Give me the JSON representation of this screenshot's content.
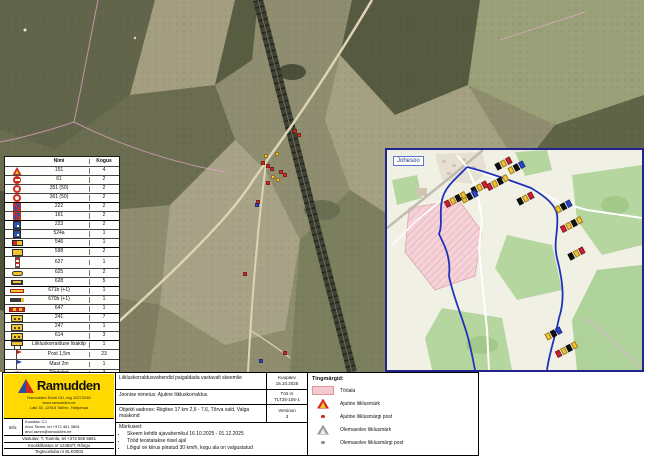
{
  "colors": {
    "brand_yellow": "#ffd900",
    "accent_red": "#cf2a1f",
    "accent_blue": "#2a52b0",
    "work_area_pink": "#f4c9cf",
    "inset_border": "#23238e",
    "route_blue": "#2233bb"
  },
  "sign_table": {
    "col_name": "Nimi",
    "col_qty": "Kogus",
    "rows": [
      {
        "icon": "tri-red",
        "name": "151",
        "qty": "4"
      },
      {
        "icon": "circ-noentry",
        "name": "61",
        "qty": "2"
      },
      {
        "icon": "circ-ring",
        "name": "351 (50)",
        "qty": "2"
      },
      {
        "icon": "circ-ring",
        "name": "361 (50)",
        "qty": "2"
      },
      {
        "icon": "sq-bluered",
        "name": "222",
        "qty": "2"
      },
      {
        "icon": "sq-bluered",
        "name": "161",
        "qty": "2"
      },
      {
        "icon": "sq-blue",
        "name": "223",
        "qty": "2"
      },
      {
        "icon": "sq-blue",
        "name": "524a",
        "qty": "1"
      },
      {
        "icon": "bar-yr",
        "name": "546",
        "qty": "1"
      },
      {
        "icon": "rect-y",
        "name": "598",
        "qty": "2"
      },
      {
        "icon": "pole",
        "name": "627",
        "qty": "1"
      },
      {
        "icon": "oval-y",
        "name": "625",
        "qty": "2"
      },
      {
        "icon": "rect-dk",
        "name": "628",
        "qty": "5"
      },
      {
        "icon": "bar-ylong",
        "name": "671b (+1)",
        "qty": "1"
      },
      {
        "icon": "bar-dark",
        "name": "670b (+1)",
        "qty": "1"
      },
      {
        "icon": "bar-striped",
        "name": "647",
        "qty": "1"
      },
      {
        "icon": "rect-ydots",
        "name": "241",
        "qty": "7"
      },
      {
        "icon": "rect-ydots",
        "name": "247",
        "qty": "1"
      },
      {
        "icon": "rect-ydots",
        "name": "614",
        "qty": "3"
      },
      {
        "icon": "board",
        "name": "Liikluskorralduse lisakilp",
        "qty": "1"
      },
      {
        "icon": "flag-red",
        "name": "Post 1,5m",
        "qty": "23"
      },
      {
        "icon": "flag-blue",
        "name": "Mast 2m",
        "qty": "1"
      },
      {
        "icon": "zigzag",
        "name": "Piirdelint",
        "qty": "3"
      }
    ],
    "group_breaks": [
      4,
      6,
      9,
      13,
      16,
      19
    ]
  },
  "map": {
    "markers": [
      {
        "x": 293,
        "y": 129,
        "c": "red"
      },
      {
        "x": 297,
        "y": 133,
        "c": "red"
      },
      {
        "x": 275,
        "y": 152,
        "c": "yellow"
      },
      {
        "x": 264,
        "y": 154,
        "c": "yellow"
      },
      {
        "x": 261,
        "y": 161,
        "c": "red"
      },
      {
        "x": 266,
        "y": 164,
        "c": "red"
      },
      {
        "x": 270,
        "y": 167,
        "c": "red"
      },
      {
        "x": 279,
        "y": 170,
        "c": "red"
      },
      {
        "x": 283,
        "y": 173,
        "c": "red"
      },
      {
        "x": 271,
        "y": 175,
        "c": "yellow"
      },
      {
        "x": 276,
        "y": 178,
        "c": "yellow"
      },
      {
        "x": 266,
        "y": 181,
        "c": "red"
      },
      {
        "x": 256,
        "y": 200,
        "c": "red"
      },
      {
        "x": 255,
        "y": 203,
        "c": "blue"
      },
      {
        "x": 243,
        "y": 272,
        "c": "red"
      },
      {
        "x": 283,
        "y": 351,
        "c": "red"
      },
      {
        "x": 259,
        "y": 359,
        "c": "blue"
      }
    ]
  },
  "inset": {
    "label": "Johesoo",
    "clusters": [
      {
        "x": 108,
        "y": 10
      },
      {
        "x": 121,
        "y": 14
      },
      {
        "x": 99,
        "y": 29
      },
      {
        "x": 84,
        "y": 34
      },
      {
        "x": 74,
        "y": 43
      },
      {
        "x": 57,
        "y": 46
      },
      {
        "x": 130,
        "y": 45
      },
      {
        "x": 168,
        "y": 53
      },
      {
        "x": 173,
        "y": 71
      },
      {
        "x": 181,
        "y": 100
      },
      {
        "x": 158,
        "y": 180
      },
      {
        "x": 168,
        "y": 196
      }
    ]
  },
  "legend": {
    "title": "Tingmärgid:",
    "items": [
      {
        "icon": "lg-pink",
        "label": "Tööala"
      },
      {
        "icon": "lg-tri-red",
        "label": "Ajutine liiklusmärk"
      },
      {
        "icon": "lg-dot-red",
        "label": "Ajutine liiklusmärgi post"
      },
      {
        "icon": "lg-tri-gray",
        "label": "Olemasolev liiklusmärk"
      },
      {
        "icon": "lg-dot-gray",
        "label": "Olemasolev liiklusmärgi post"
      }
    ]
  },
  "titleblock": {
    "row1": "Liikluskorraldusvahendid paigaldada vastavalt skeemile",
    "date_label": "Kuupäev",
    "date": "16.10.2025",
    "drawing_label": "Joonise nimetus:",
    "drawing": "Ajutine liikluskorraldus.",
    "job_label": "Töö nr",
    "job": "TLT25-105-1",
    "address_label": "Objekti aadress:",
    "address": "Riigitee 17 km 2,6 - 7,6, Tõrva vald, Valga maakond",
    "version_label": "Versioon",
    "version": "3",
    "notes_label": "Märkused:",
    "notes": [
      "Skeem kehtib ajavahemikul 16.10.2025 - 01.12.2025",
      "Tööd teostatakse öisel ajal",
      "Lõigul on kiirus piiratud 30 km/h, kogu ala on valgustatud"
    ]
  },
  "company": {
    "brand": "Ramudden",
    "addr1": "Ramudden Eesti OÜ, reg 10272040",
    "addr2": "www.ramudden.ee",
    "addr3": "Laki 30, 12915 Tallinn, Harjumaa",
    "info_label": "Info:",
    "line1": "Koostas: CJ",
    "line2": "Arvo Tamm, tel +372 461 3804",
    "line3": "arvo.tamm@ramudden.ee",
    "line4": "Vastutav: T. Toomla, tel +372 566 5661",
    "line5": "Kooskõlastus nr 12493/T, Rõngu",
    "line6": "Tegevusluba nr ELK0003"
  }
}
